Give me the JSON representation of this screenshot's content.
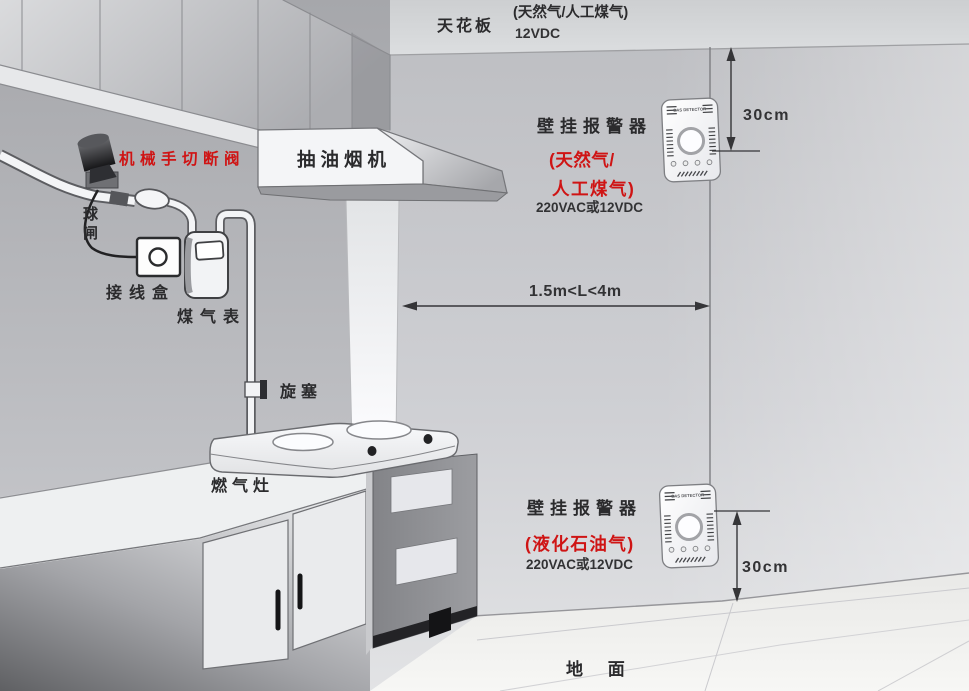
{
  "scene": {
    "ceiling_label": "天花板",
    "ground_label": "地 面"
  },
  "top_note": {
    "line1": "(天然气/人工煤气)",
    "line2": "12VDC"
  },
  "alarm_top": {
    "title": "壁挂报警器",
    "gas_type_line1": "(天然气/",
    "gas_type_line2": "人工煤气)",
    "power": "220VAC或12VDC",
    "device_label": "GAS DETECTOR"
  },
  "alarm_bottom": {
    "title": "壁挂报警器",
    "gas_type": "(液化石油气)",
    "power": "220VAC或12VDC",
    "device_label": "GAS DETECTOR"
  },
  "measurements": {
    "top_clearance": "30cm",
    "bottom_clearance": "30cm",
    "horizontal_distance": "1.5m<L<4m"
  },
  "equipment": {
    "range_hood": "抽油烟机",
    "shutoff_valve": "机械手切断阀",
    "ball_valve_chars": [
      "球",
      "闸"
    ],
    "junction_box": "接线盒",
    "gas_meter": "煤气表",
    "plug_valve": "旋塞",
    "gas_stove": "燃气灶"
  },
  "colors": {
    "accent_red": "#cf1414",
    "text_dark": "#2b2b2d",
    "line": "#353538"
  }
}
